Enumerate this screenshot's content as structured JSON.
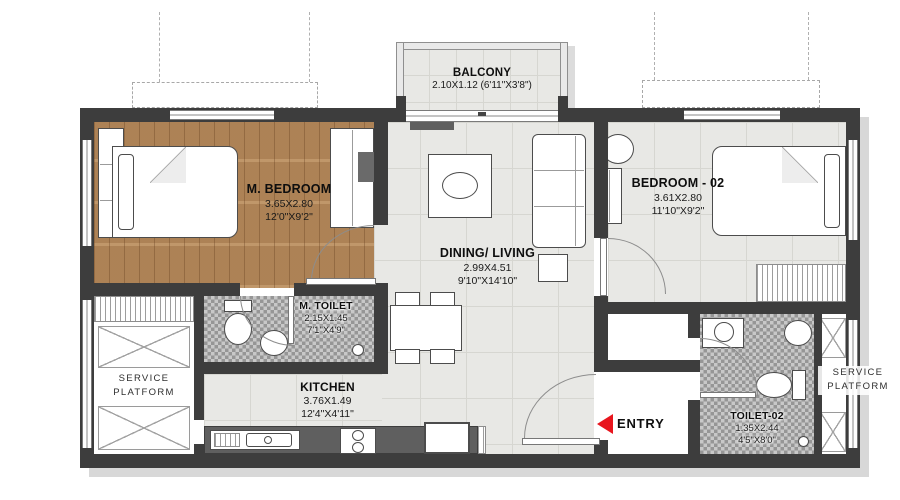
{
  "rooms": {
    "balcony": {
      "name": "BALCONY",
      "dims": "2.10X1.12 (6'11\"X3'8\")"
    },
    "m_bedroom": {
      "name": "M. BEDROOM",
      "dims_m": "3.65X2.80",
      "dims_ft": "12'0\"X9'2\""
    },
    "bedroom_02": {
      "name": "BEDROOM - 02",
      "dims_m": "3.61X2.80",
      "dims_ft": "11'10\"X9'2\""
    },
    "dining_living": {
      "name": "DINING/ LIVING",
      "dims_m": "2.99X4.51",
      "dims_ft": "9'10\"X14'10\""
    },
    "m_toilet": {
      "name": "M. TOILET",
      "dims_m": "2.15X1.45",
      "dims_ft": "7'1\"X4'9\""
    },
    "kitchen": {
      "name": "KITCHEN",
      "dims_m": "3.76X1.49",
      "dims_ft": "12'4\"X4'11\""
    },
    "toilet_02": {
      "name": "TOILET-02",
      "dims_m": "1.35X2.44",
      "dims_ft": "4'5\"X8'0\""
    },
    "service_platform_left": {
      "line1": "SERVICE",
      "line2": "PLATFORM"
    },
    "service_platform_right": {
      "line1": "SERVICE",
      "line2": "PLATFORM"
    },
    "entry": {
      "label": "ENTRY"
    }
  },
  "colors": {
    "wall": "#3d3d3d",
    "wood_floor": "#b6895a",
    "tile_floor": "#e8e8e5",
    "mosaic_dark": "#969696",
    "mosaic_light": "#c8c8c8",
    "entry_arrow_red": "#e8151d",
    "shadow": "#d8d8d8"
  }
}
